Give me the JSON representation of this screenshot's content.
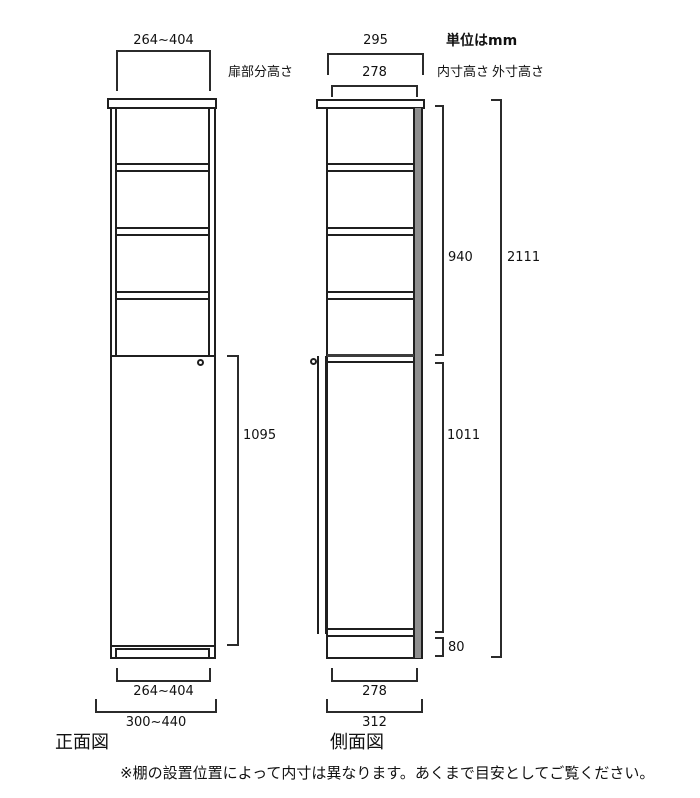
{
  "units_label": "単位はmm",
  "front_view": {
    "label": "正面図",
    "top_width": "264~404",
    "door_section_label": "扉部分高さ",
    "door_height": "1095",
    "bottom_inner_width": "264~404",
    "bottom_outer_width": "300~440"
  },
  "side_view": {
    "label": "側面図",
    "top_outer_depth": "295",
    "top_inner_depth": "278",
    "inner_height_label": "内寸高さ",
    "outer_height_label": "外寸高さ",
    "upper_inner_height": "940",
    "total_height": "2111",
    "lower_inner_height": "1011",
    "base_height": "80",
    "bottom_inner_depth": "278",
    "bottom_outer_depth": "312"
  },
  "footer_note": "※棚の設置位置によって内寸は異なります。あくまで目安としてご覧ください。",
  "colors": {
    "line": "#1f1f1f",
    "back_panel": "#8f8f8f",
    "background": "#ffffff"
  }
}
